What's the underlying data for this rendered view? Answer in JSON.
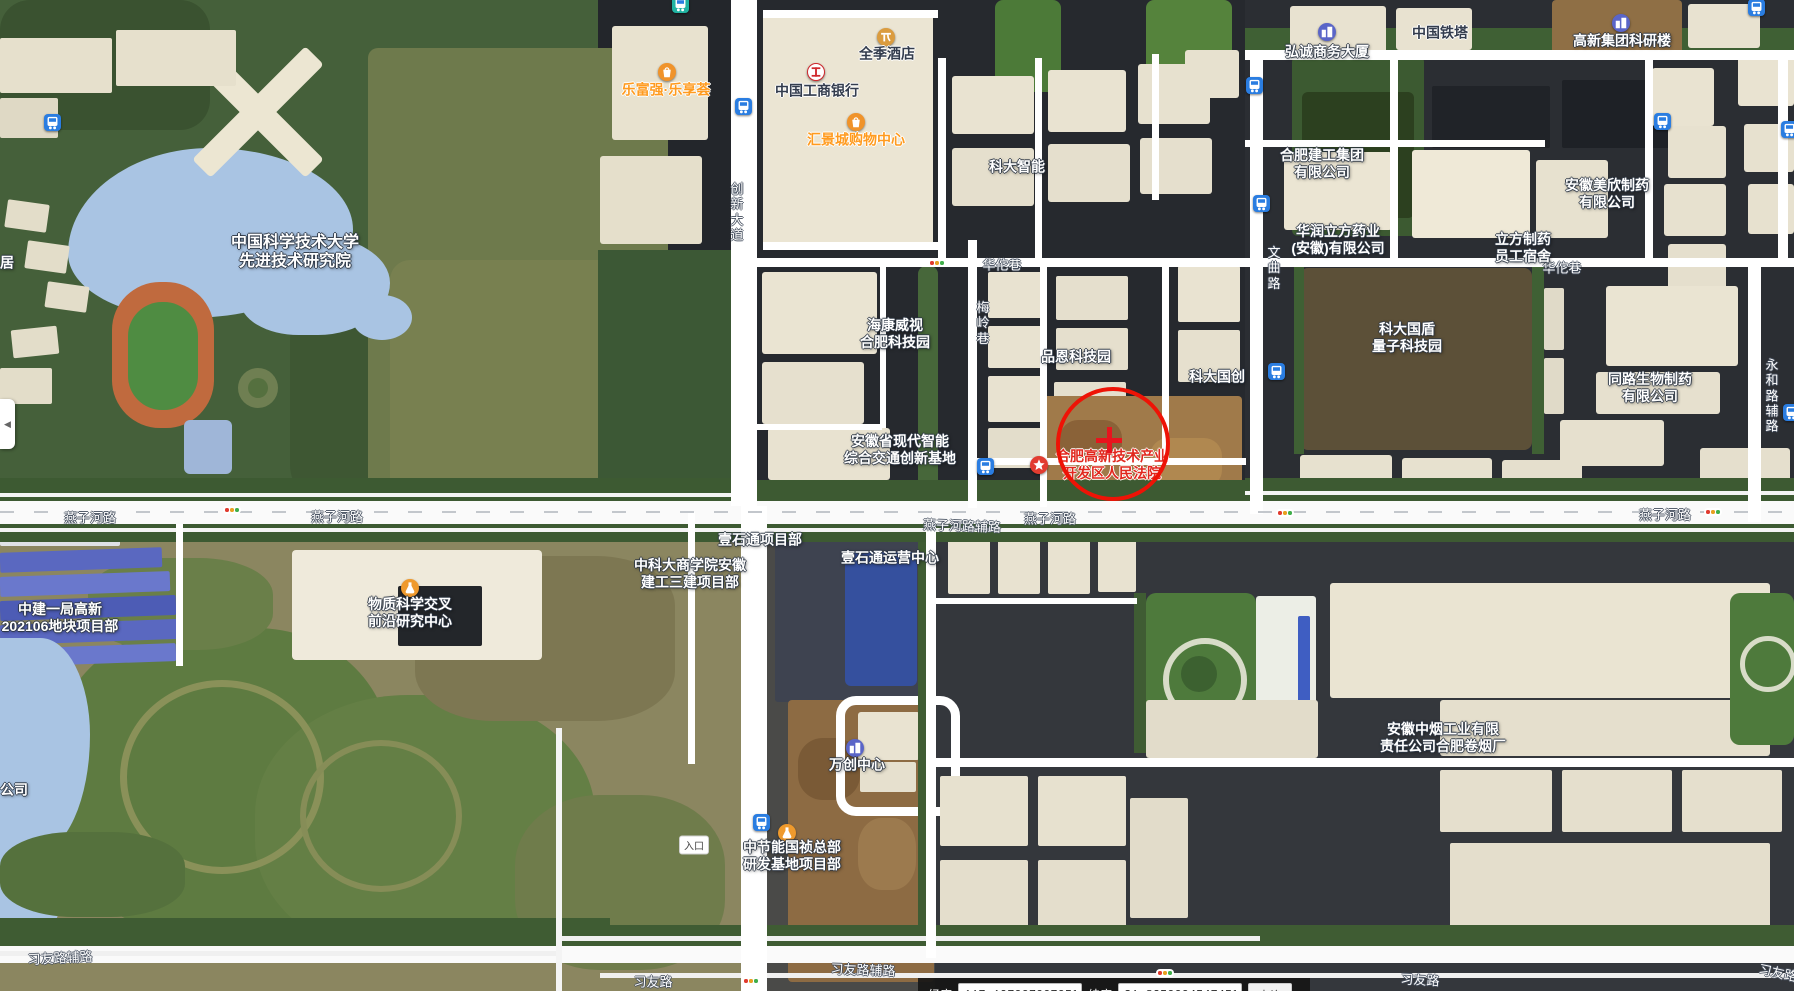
{
  "map": {
    "poi_labels": [
      {
        "name": "ustc-institute",
        "lines": [
          "中国科学技术大学",
          "先进技术研究院"
        ],
        "x": 295,
        "y": 252,
        "style": "white big"
      },
      {
        "name": "lefuqiang-plaza",
        "lines": [
          "乐富强·乐享荟"
        ],
        "x": 666,
        "y": 90,
        "style": "orange",
        "icon": "shopping-bag",
        "icon_x": 667,
        "icon_y": 72
      },
      {
        "name": "quanji-hotel",
        "lines": [
          "全季酒店"
        ],
        "x": 887,
        "y": 54,
        "style": "dark",
        "icon": "hotel",
        "icon_x": 886,
        "icon_y": 37
      },
      {
        "name": "icbc-bank",
        "lines": [
          "中国工商银行"
        ],
        "x": 817,
        "y": 91,
        "style": "dark",
        "icon": "bank",
        "icon_x": 816,
        "icon_y": 72
      },
      {
        "name": "huijing-mall",
        "lines": [
          "汇景城购物中心"
        ],
        "x": 856,
        "y": 140,
        "style": "orange",
        "icon": "shopping-bag",
        "icon_x": 856,
        "icon_y": 122
      },
      {
        "name": "keda-intelligent",
        "lines": [
          "科大智能"
        ],
        "x": 1017,
        "y": 167,
        "style": "white"
      },
      {
        "name": "hongcheng-tower",
        "lines": [
          "弘诚商务大厦"
        ],
        "x": 1327,
        "y": 52,
        "style": "white",
        "icon": "building",
        "icon_x": 1327,
        "icon_y": 32
      },
      {
        "name": "china-tower",
        "lines": [
          "中国铁塔"
        ],
        "x": 1440,
        "y": 33,
        "style": "dark"
      },
      {
        "name": "gaoxin-research",
        "lines": [
          "高新集团科研楼"
        ],
        "x": 1622,
        "y": 41,
        "style": "white",
        "icon": "building",
        "icon_x": 1621,
        "icon_y": 23
      },
      {
        "name": "hefei-construction",
        "lines": [
          "合肥建工集团",
          "有限公司"
        ],
        "x": 1322,
        "y": 164,
        "style": "white"
      },
      {
        "name": "huarun-pharma",
        "lines": [
          "华润立方药业",
          "(安徽)有限公司"
        ],
        "x": 1338,
        "y": 240,
        "style": "white"
      },
      {
        "name": "lifang-dorm",
        "lines": [
          "立方制药",
          "员工宿舍"
        ],
        "x": 1523,
        "y": 248,
        "style": "white"
      },
      {
        "name": "meixin-pharma",
        "lines": [
          "安徽美欣制药",
          "有限公司"
        ],
        "x": 1607,
        "y": 194,
        "style": "white"
      },
      {
        "name": "hikvision-park",
        "lines": [
          "海康威视",
          "合肥科技园"
        ],
        "x": 895,
        "y": 334,
        "style": "white"
      },
      {
        "name": "pinen-techpark",
        "lines": [
          "品恩科技园"
        ],
        "x": 1076,
        "y": 357,
        "style": "white"
      },
      {
        "name": "keda-guochuang",
        "lines": [
          "科大国创"
        ],
        "x": 1217,
        "y": 377,
        "style": "white"
      },
      {
        "name": "guodun-quantum",
        "lines": [
          "科大国盾",
          "量子科技园"
        ],
        "x": 1407,
        "y": 338,
        "style": "white"
      },
      {
        "name": "tonglu-bio",
        "lines": [
          "同路生物制药",
          "有限公司"
        ],
        "x": 1650,
        "y": 388,
        "style": "white"
      },
      {
        "name": "transport-base",
        "lines": [
          "安徽省现代智能",
          "综合交通创新基地"
        ],
        "x": 900,
        "y": 450,
        "style": "white"
      },
      {
        "name": "hightech-court",
        "lines": [
          "合肥高新技术产业",
          "开发区人民法院"
        ],
        "x": 1112,
        "y": 465,
        "style": "red",
        "icon": "court-star",
        "icon_x": 1039,
        "icon_y": 465
      },
      {
        "name": "material-science-center",
        "lines": [
          "物质科学交叉",
          "前沿研究中心"
        ],
        "x": 410,
        "y": 613,
        "style": "white",
        "icon": "flask",
        "icon_x": 410,
        "icon_y": 588
      },
      {
        "name": "zhongjian-project",
        "lines": [
          "中建一局高新",
          "202106地块项目部"
        ],
        "x": 60,
        "y": 618,
        "style": "white"
      },
      {
        "name": "ustc-bschool-project",
        "lines": [
          "中科大商学院安徽",
          "建工三建项目部"
        ],
        "x": 690,
        "y": 574,
        "style": "white"
      },
      {
        "name": "yishitong-project",
        "lines": [
          "壹石通项目部"
        ],
        "x": 760,
        "y": 540,
        "style": "white"
      },
      {
        "name": "yishitong-center",
        "lines": [
          "壹石通运营中心"
        ],
        "x": 890,
        "y": 558,
        "style": "white"
      },
      {
        "name": "wanchuang-center",
        "lines": [
          "万创中心"
        ],
        "x": 857,
        "y": 765,
        "style": "white",
        "icon": "building",
        "icon_x": 855,
        "icon_y": 748
      },
      {
        "name": "cecep-project",
        "lines": [
          "中节能国祯总部",
          "研发基地项目部"
        ],
        "x": 792,
        "y": 856,
        "style": "white",
        "icon": "flask",
        "icon_x": 787,
        "icon_y": 833
      },
      {
        "name": "tobacco-factory",
        "lines": [
          "安徽中烟工业有限",
          "责任公司合肥卷烟厂"
        ],
        "x": 1443,
        "y": 738,
        "style": "white"
      },
      {
        "name": "partial-label-ju",
        "lines": [
          "居"
        ],
        "x": 7,
        "y": 263,
        "style": "white"
      },
      {
        "name": "partial-label-gongsi",
        "lines": [
          "公司"
        ],
        "x": 14,
        "y": 790,
        "style": "white"
      }
    ],
    "road_labels": [
      {
        "text": "燕子河路",
        "x": 90,
        "y": 517
      },
      {
        "text": "燕子河路",
        "x": 337,
        "y": 516
      },
      {
        "text": "燕子河路辅路",
        "x": 962,
        "y": 525,
        "rot": 2
      },
      {
        "text": "燕子河路",
        "x": 1050,
        "y": 518
      },
      {
        "text": "燕子河路",
        "x": 1665,
        "y": 514
      },
      {
        "text": "习友路辅路",
        "x": 60,
        "y": 957,
        "rot": -3
      },
      {
        "text": "习友路",
        "x": 653,
        "y": 981
      },
      {
        "text": "习友路辅路",
        "x": 863,
        "y": 969,
        "rot": 2
      },
      {
        "text": "习友路",
        "x": 1420,
        "y": 979,
        "rot": 3
      },
      {
        "text": "习友路",
        "x": 1778,
        "y": 972,
        "rot": 12
      },
      {
        "text": "华佗巷",
        "x": 1002,
        "y": 264
      },
      {
        "text": "华佗巷",
        "x": 1562,
        "y": 267
      },
      {
        "text": "创新大道",
        "x": 737,
        "y": 212,
        "vertical": true
      },
      {
        "text": "文曲路",
        "x": 1274,
        "y": 268,
        "vertical": true
      },
      {
        "text": "梅岭巷",
        "x": 983,
        "y": 323,
        "vertical": true
      },
      {
        "text": "永和路辅路",
        "x": 1772,
        "y": 396,
        "vertical": true
      }
    ],
    "transit_icons": [
      {
        "type": "bus",
        "x": 53,
        "y": 123
      },
      {
        "type": "bus",
        "x": 744,
        "y": 107
      },
      {
        "type": "bus-teal",
        "x": 681,
        "y": 5
      },
      {
        "type": "bus",
        "x": 1255,
        "y": 86
      },
      {
        "type": "bus",
        "x": 1262,
        "y": 204
      },
      {
        "type": "bus",
        "x": 1663,
        "y": 122
      },
      {
        "type": "bus",
        "x": 1790,
        "y": 130
      },
      {
        "type": "bus",
        "x": 1277,
        "y": 372
      },
      {
        "type": "bus",
        "x": 986,
        "y": 467
      },
      {
        "type": "bus",
        "x": 762,
        "y": 823
      },
      {
        "type": "bus",
        "x": 1757,
        "y": 8
      },
      {
        "type": "bus",
        "x": 1792,
        "y": 413
      }
    ],
    "traffic_lights": [
      {
        "x": 937,
        "y": 263
      },
      {
        "x": 232,
        "y": 510
      },
      {
        "x": 1285,
        "y": 513
      },
      {
        "x": 1713,
        "y": 512
      },
      {
        "x": 751,
        "y": 981
      },
      {
        "x": 1165,
        "y": 973
      }
    ],
    "entrance_badge": {
      "text": "入口",
      "x": 694,
      "y": 845
    },
    "annotation": {
      "shape": "circle",
      "cx": 1109,
      "cy": 440,
      "r": 53,
      "color": "#ee1306",
      "stroke": 4,
      "crosshair": {
        "len": 26,
        "thick": 5,
        "color": "#e8141e"
      }
    }
  },
  "controls": {
    "panel_toggle_glyph": "◀"
  },
  "coordinate_bar": {
    "lng_label": "经度",
    "lng_value": "117.1970070070507",
    "lat_label": "纬度",
    "lat_value": "31.82500045474504",
    "submit_label": "查询"
  },
  "colors": {
    "annotation_red": "#ee1306",
    "poi_orange": "#ff9b1f",
    "bus_blue": "#2a7de1",
    "water_blue": "#a9c4e3",
    "road_white": "#fafafa"
  }
}
